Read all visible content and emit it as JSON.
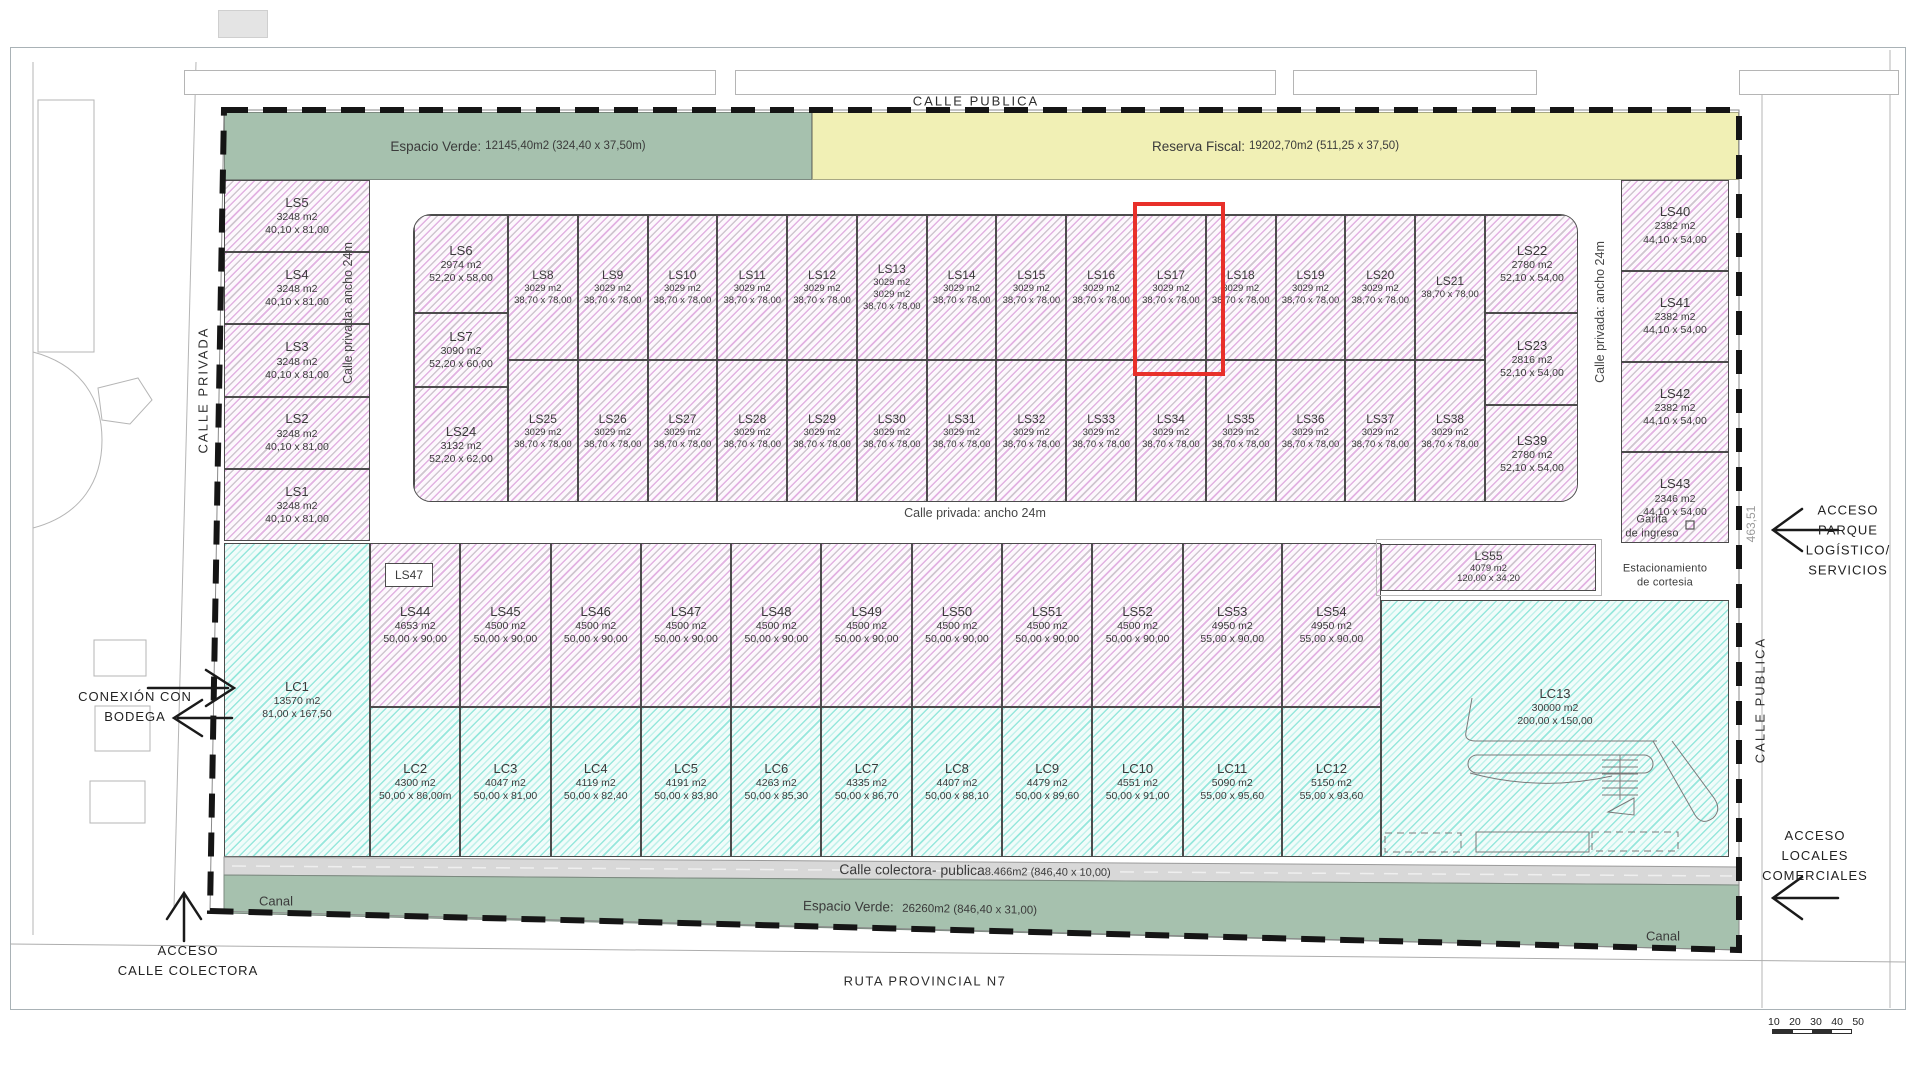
{
  "header": {
    "calle_publica_top": "CALLE PUBLICA"
  },
  "streets": {
    "calle_privada_outside": "CALLE PRIVADA",
    "calle_privada_inner_left": "Calle privada: ancho 24m",
    "calle_privada_inner_right": "Calle privada: ancho 24m",
    "calle_privada_inner_bottom": "Calle privada: ancho 24m",
    "calle_publica_right": "CALLE PUBLICA",
    "ruta": "RUTA PROVINCIAL N7",
    "colectora_name": "Calle colectora- publica",
    "colectora_value": "8.466m2 (846,40 x 10,00)"
  },
  "zones": {
    "espacio_verde_top": {
      "label": "Espacio Verde:",
      "value": "12145,40m2 (324,40 x 37,50m)"
    },
    "reserva_fiscal": {
      "label": "Reserva Fiscal:",
      "value": "19202,70m2 (511,25 x 37,50)"
    },
    "espacio_verde_bottom": {
      "label": "Espacio Verde:",
      "value": "26260m2 (846,40 x 31,00)"
    },
    "canal_left": "Canal",
    "canal_right": "Canal"
  },
  "annotations": {
    "garita_line1": "Garita",
    "garita_line2": "de ingreso",
    "estacionamiento_line1": "Estacionamiento",
    "estacionamiento_line2": "de cortesia",
    "dim_463": "463,51",
    "acceso_parque": [
      "ACCESO",
      "PARQUE",
      "LOGÍSTICO/",
      "SERVICIOS"
    ],
    "acceso_locales": [
      "ACCESO",
      "LOCALES",
      "COMERCIALES"
    ],
    "conexion": [
      "CONEXIÓN CON",
      "BODEGA"
    ],
    "acceso_colectora": [
      "ACCESO",
      "CALLE COLECTORA"
    ],
    "ls47_tag": "LS47",
    "scale_ticks": [
      "10",
      "20",
      "30",
      "40",
      "50"
    ]
  },
  "highlight": {
    "lot": "LS17",
    "color": "#e8302a"
  },
  "lots_left": [
    {
      "name": "LS5",
      "area": "3248 m2",
      "dims": "40,10 x 81,00"
    },
    {
      "name": "LS4",
      "area": "3248 m2",
      "dims": "40,10 x 81,00"
    },
    {
      "name": "LS3",
      "area": "3248 m2",
      "dims": "40,10 x 81,00"
    },
    {
      "name": "LS2",
      "area": "3248 m2",
      "dims": "40,10 x 81,00"
    },
    {
      "name": "LS1",
      "area": "3248 m2",
      "dims": "40,10 x 81,00"
    }
  ],
  "block_col1": [
    {
      "name": "LS6",
      "area": "2974 m2",
      "dims": "52,20 x 58,00",
      "w": 98
    },
    {
      "name": "LS7",
      "area": "3090 m2",
      "dims": "52,20 x 60,00",
      "w": 74
    },
    {
      "name": "LS24",
      "area": "3132 m2",
      "dims": "52,20 x 62,00",
      "w": 116
    }
  ],
  "block_top_row": [
    {
      "name": "LS8",
      "area": "3029 m2",
      "dims": "38,70 x 78,00"
    },
    {
      "name": "LS9",
      "area": "3029 m2",
      "dims": "38,70 x 78,00"
    },
    {
      "name": "LS10",
      "area": "3029 m2",
      "dims": "38,70 x 78,00"
    },
    {
      "name": "LS11",
      "area": "3029 m2",
      "dims": "38,70 x 78,00"
    },
    {
      "name": "LS12",
      "area": "3029 m2",
      "dims": "38,70 x 78,00"
    },
    {
      "name": "LS13",
      "area": "3029 m2",
      "extra": "3029 m2",
      "dims": "38,70 x 78,00"
    },
    {
      "name": "LS14",
      "area": "3029 m2",
      "dims": "38,70 x 78,00"
    },
    {
      "name": "LS15",
      "area": "3029 m2",
      "dims": "38,70 x 78,00"
    },
    {
      "name": "LS16",
      "area": "3029 m2",
      "dims": "38,70 x 78,00"
    },
    {
      "name": "LS17",
      "area": "3029 m2",
      "dims": "38,70 x 78,00"
    },
    {
      "name": "LS18",
      "area": "3029 m2",
      "dims": "38,70 x 78,00"
    },
    {
      "name": "LS19",
      "area": "3029 m2",
      "dims": "38,70 x 78,00"
    },
    {
      "name": "LS20",
      "area": "3029 m2",
      "dims": "38,70 x 78,00"
    },
    {
      "name": "LS21",
      "area": "",
      "dims": "38,70 x 78,00"
    }
  ],
  "block_bottom_row": [
    {
      "name": "LS25",
      "area": "3029 m2",
      "dims": "38,70 x 78,00"
    },
    {
      "name": "LS26",
      "area": "3029 m2",
      "dims": "38,70 x 78,00"
    },
    {
      "name": "LS27",
      "area": "3029 m2",
      "dims": "38,70 x 78,00"
    },
    {
      "name": "LS28",
      "area": "3029 m2",
      "dims": "38,70 x 78,00"
    },
    {
      "name": "LS29",
      "area": "3029 m2",
      "dims": "38,70 x 78,00"
    },
    {
      "name": "LS30",
      "area": "3029 m2",
      "dims": "38,70 x 78,00"
    },
    {
      "name": "LS31",
      "area": "3029 m2",
      "dims": "38,70 x 78,00"
    },
    {
      "name": "LS32",
      "area": "3029 m2",
      "dims": "38,70 x 78,00"
    },
    {
      "name": "LS33",
      "area": "3029 m2",
      "dims": "38,70 x 78,00"
    },
    {
      "name": "LS34",
      "area": "3029 m2",
      "dims": "38,70 x 78,00"
    },
    {
      "name": "LS35",
      "area": "3029 m2",
      "dims": "38,70 x 78,00"
    },
    {
      "name": "LS36",
      "area": "3029 m2",
      "dims": "38,70 x 78,00"
    },
    {
      "name": "LS37",
      "area": "3029 m2",
      "dims": "38,70 x 78,00"
    },
    {
      "name": "LS38",
      "area": "3029 m2",
      "dims": "38,70 x 78,00"
    }
  ],
  "block_right_col": [
    {
      "name": "LS22",
      "area": "2780 m2",
      "dims": "52,10 x 54,00",
      "w": 98
    },
    {
      "name": "LS23",
      "area": "2816 m2",
      "dims": "52,10 x 54,00",
      "w": 92
    },
    {
      "name": "LS39",
      "area": "2780 m2",
      "dims": "52,10 x 54,00",
      "w": 98
    }
  ],
  "right_col": [
    {
      "name": "LS40",
      "area": "2382 m2",
      "dims": "44,10 x 54,00"
    },
    {
      "name": "LS41",
      "area": "2382 m2",
      "dims": "44,10 x 54,00"
    },
    {
      "name": "LS42",
      "area": "2382 m2",
      "dims": "44,10 x 54,00"
    },
    {
      "name": "LS43",
      "area": "2346 m2",
      "dims": "44,10 x 54,00"
    }
  ],
  "middle_row": [
    {
      "name": "LS44",
      "area": "4653 m2",
      "dims": "50,00 x 90,00"
    },
    {
      "name": "LS45",
      "area": "4500 m2",
      "dims": "50,00 x 90,00"
    },
    {
      "name": "LS46",
      "area": "4500 m2",
      "dims": "50,00 x 90,00"
    },
    {
      "name": "LS47",
      "area": "4500 m2",
      "dims": "50,00 x 90,00"
    },
    {
      "name": "LS48",
      "area": "4500 m2",
      "dims": "50,00 x 90,00"
    },
    {
      "name": "LS49",
      "area": "4500 m2",
      "dims": "50,00 x 90,00"
    },
    {
      "name": "LS50",
      "area": "4500 m2",
      "dims": "50,00 x 90,00"
    },
    {
      "name": "LS51",
      "area": "4500 m2",
      "dims": "50,00 x 90,00"
    },
    {
      "name": "LS52",
      "area": "4500 m2",
      "dims": "50,00 x 90,00"
    },
    {
      "name": "LS53",
      "area": "4950 m2",
      "dims": "55,00 x 90,00",
      "w": 1.1
    },
    {
      "name": "LS54",
      "area": "4950 m2",
      "dims": "55,00 x 90,00",
      "w": 1.1
    }
  ],
  "lc_row": [
    {
      "name": "LC2",
      "area": "4300 m2",
      "dims": "50,00 x 86,00m"
    },
    {
      "name": "LC3",
      "area": "4047 m2",
      "dims": "50,00 x 81,00"
    },
    {
      "name": "LC4",
      "area": "4119 m2",
      "dims": "50,00 x 82,40"
    },
    {
      "name": "LC5",
      "area": "4191 m2",
      "dims": "50,00 x 83,80"
    },
    {
      "name": "LC6",
      "area": "4263 m2",
      "dims": "50,00 x 85,30"
    },
    {
      "name": "LC7",
      "area": "4335 m2",
      "dims": "50,00 x 86,70"
    },
    {
      "name": "LC8",
      "area": "4407 m2",
      "dims": "50,00 x 88,10"
    },
    {
      "name": "LC9",
      "area": "4479 m2",
      "dims": "50,00 x 89,60"
    },
    {
      "name": "LC10",
      "area": "4551 m2",
      "dims": "50,00 x 91,00"
    },
    {
      "name": "LC11",
      "area": "5090 m2",
      "dims": "55,00 x 95,60",
      "w": 1.1
    },
    {
      "name": "LC12",
      "area": "5150 m2",
      "dims": "55,00 x 93,60",
      "w": 1.1
    }
  ],
  "special": {
    "lc1": {
      "name": "LC1",
      "area": "13570 m2",
      "dims": "81,00 x 167,50"
    },
    "lc13": {
      "name": "LC13",
      "area": "30000 m2",
      "dims": "200,00 x 150,00"
    },
    "ls55": {
      "name": "LS55",
      "area": "4079 m2",
      "dims": "120,00 x 34,20"
    }
  }
}
